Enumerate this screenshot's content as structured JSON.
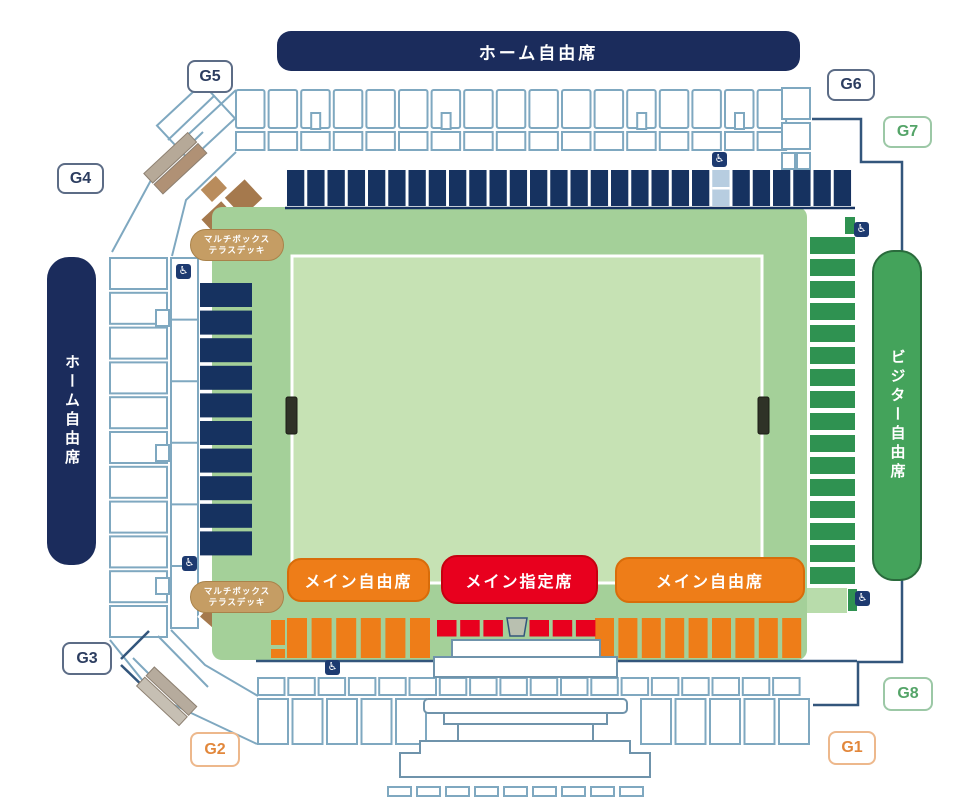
{
  "stadium": {
    "stands": {
      "back": "ホーム自由席",
      "home_side": "ホーム自由席",
      "visitor_side": "ビジター自由席",
      "main_free_left": "メイン自由席",
      "main_reserved": "メイン指定席",
      "main_free_right": "メイン自由席"
    },
    "multibox": {
      "line1": "マルチボックス",
      "line2": "テラスデッキ"
    },
    "gates": {
      "g1": "G1",
      "g2": "G2",
      "g3": "G3",
      "g4": "G4",
      "g5": "G5",
      "g6": "G6",
      "g7": "G7",
      "g8": "G8"
    },
    "icons": {
      "wheelchair": "♿"
    },
    "colors": {
      "home_navy": "#1b2c5c",
      "seat_navy": "#163260",
      "visitor_green": "#44a35b",
      "seat_green": "#2f9251",
      "main_free_orange": "#ee7d18",
      "main_reserved_red": "#e8001e",
      "multibox_tan": "#c59d64",
      "multibox_brown": "#a5794d",
      "concourse_green": "#a4d099",
      "pitch_green": "#c6e2b4",
      "ring_outline": "#7fa8c0",
      "boundary_wall": "#33567c"
    },
    "seat_counts": {
      "back_stand_blocks": 28,
      "home_side_rows": 10,
      "visitor_side_rows": 16,
      "main_free_left_blocks": 6,
      "main_free_right_blocks": 9,
      "main_reserved_blocks": 6
    }
  }
}
